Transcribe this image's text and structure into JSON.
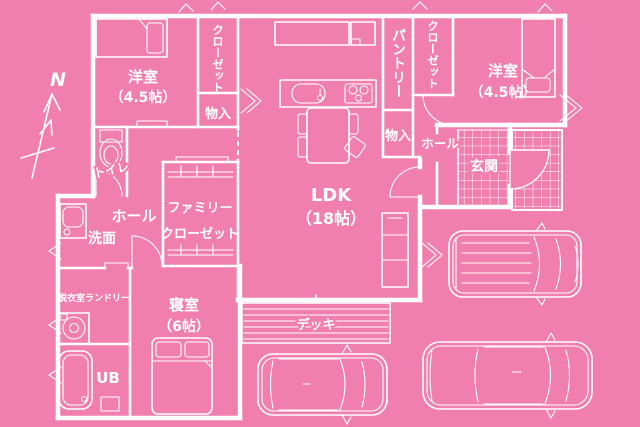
{
  "floorplan": {
    "compass": {
      "north_label": "N"
    },
    "colors": {
      "background_pink": "#f07fae",
      "line_white": "#ffffff"
    },
    "rooms": {
      "bedroom_nw": {
        "name": "洋室",
        "size": "（4.5帖）"
      },
      "closet_nw": {
        "name": "クローゼット"
      },
      "storage_nw": {
        "name": "物入"
      },
      "pantry": {
        "name": "パントリー"
      },
      "closet_ne": {
        "name": "クローゼット"
      },
      "bedroom_ne": {
        "name": "洋室",
        "size": "（4.5帖）"
      },
      "storage_e": {
        "name": "物入"
      },
      "hall_e": {
        "name": "ホール"
      },
      "entrance": {
        "name": "玄関"
      },
      "toilet": {
        "name": "トイレ"
      },
      "hall_w": {
        "name": "ホール"
      },
      "washroom": {
        "name": "洗面"
      },
      "family_closet": {
        "line1": "ファミリー",
        "line2": "クローゼット"
      },
      "ldk": {
        "name": "LDK",
        "size": "（18帖）"
      },
      "laundry": {
        "name": "脱衣室ランドリー"
      },
      "bedroom_s": {
        "name": "寝室",
        "size": "（6帖）"
      },
      "unit_bath": {
        "name": "UB"
      },
      "deck": {
        "name": "デッキ"
      }
    }
  }
}
